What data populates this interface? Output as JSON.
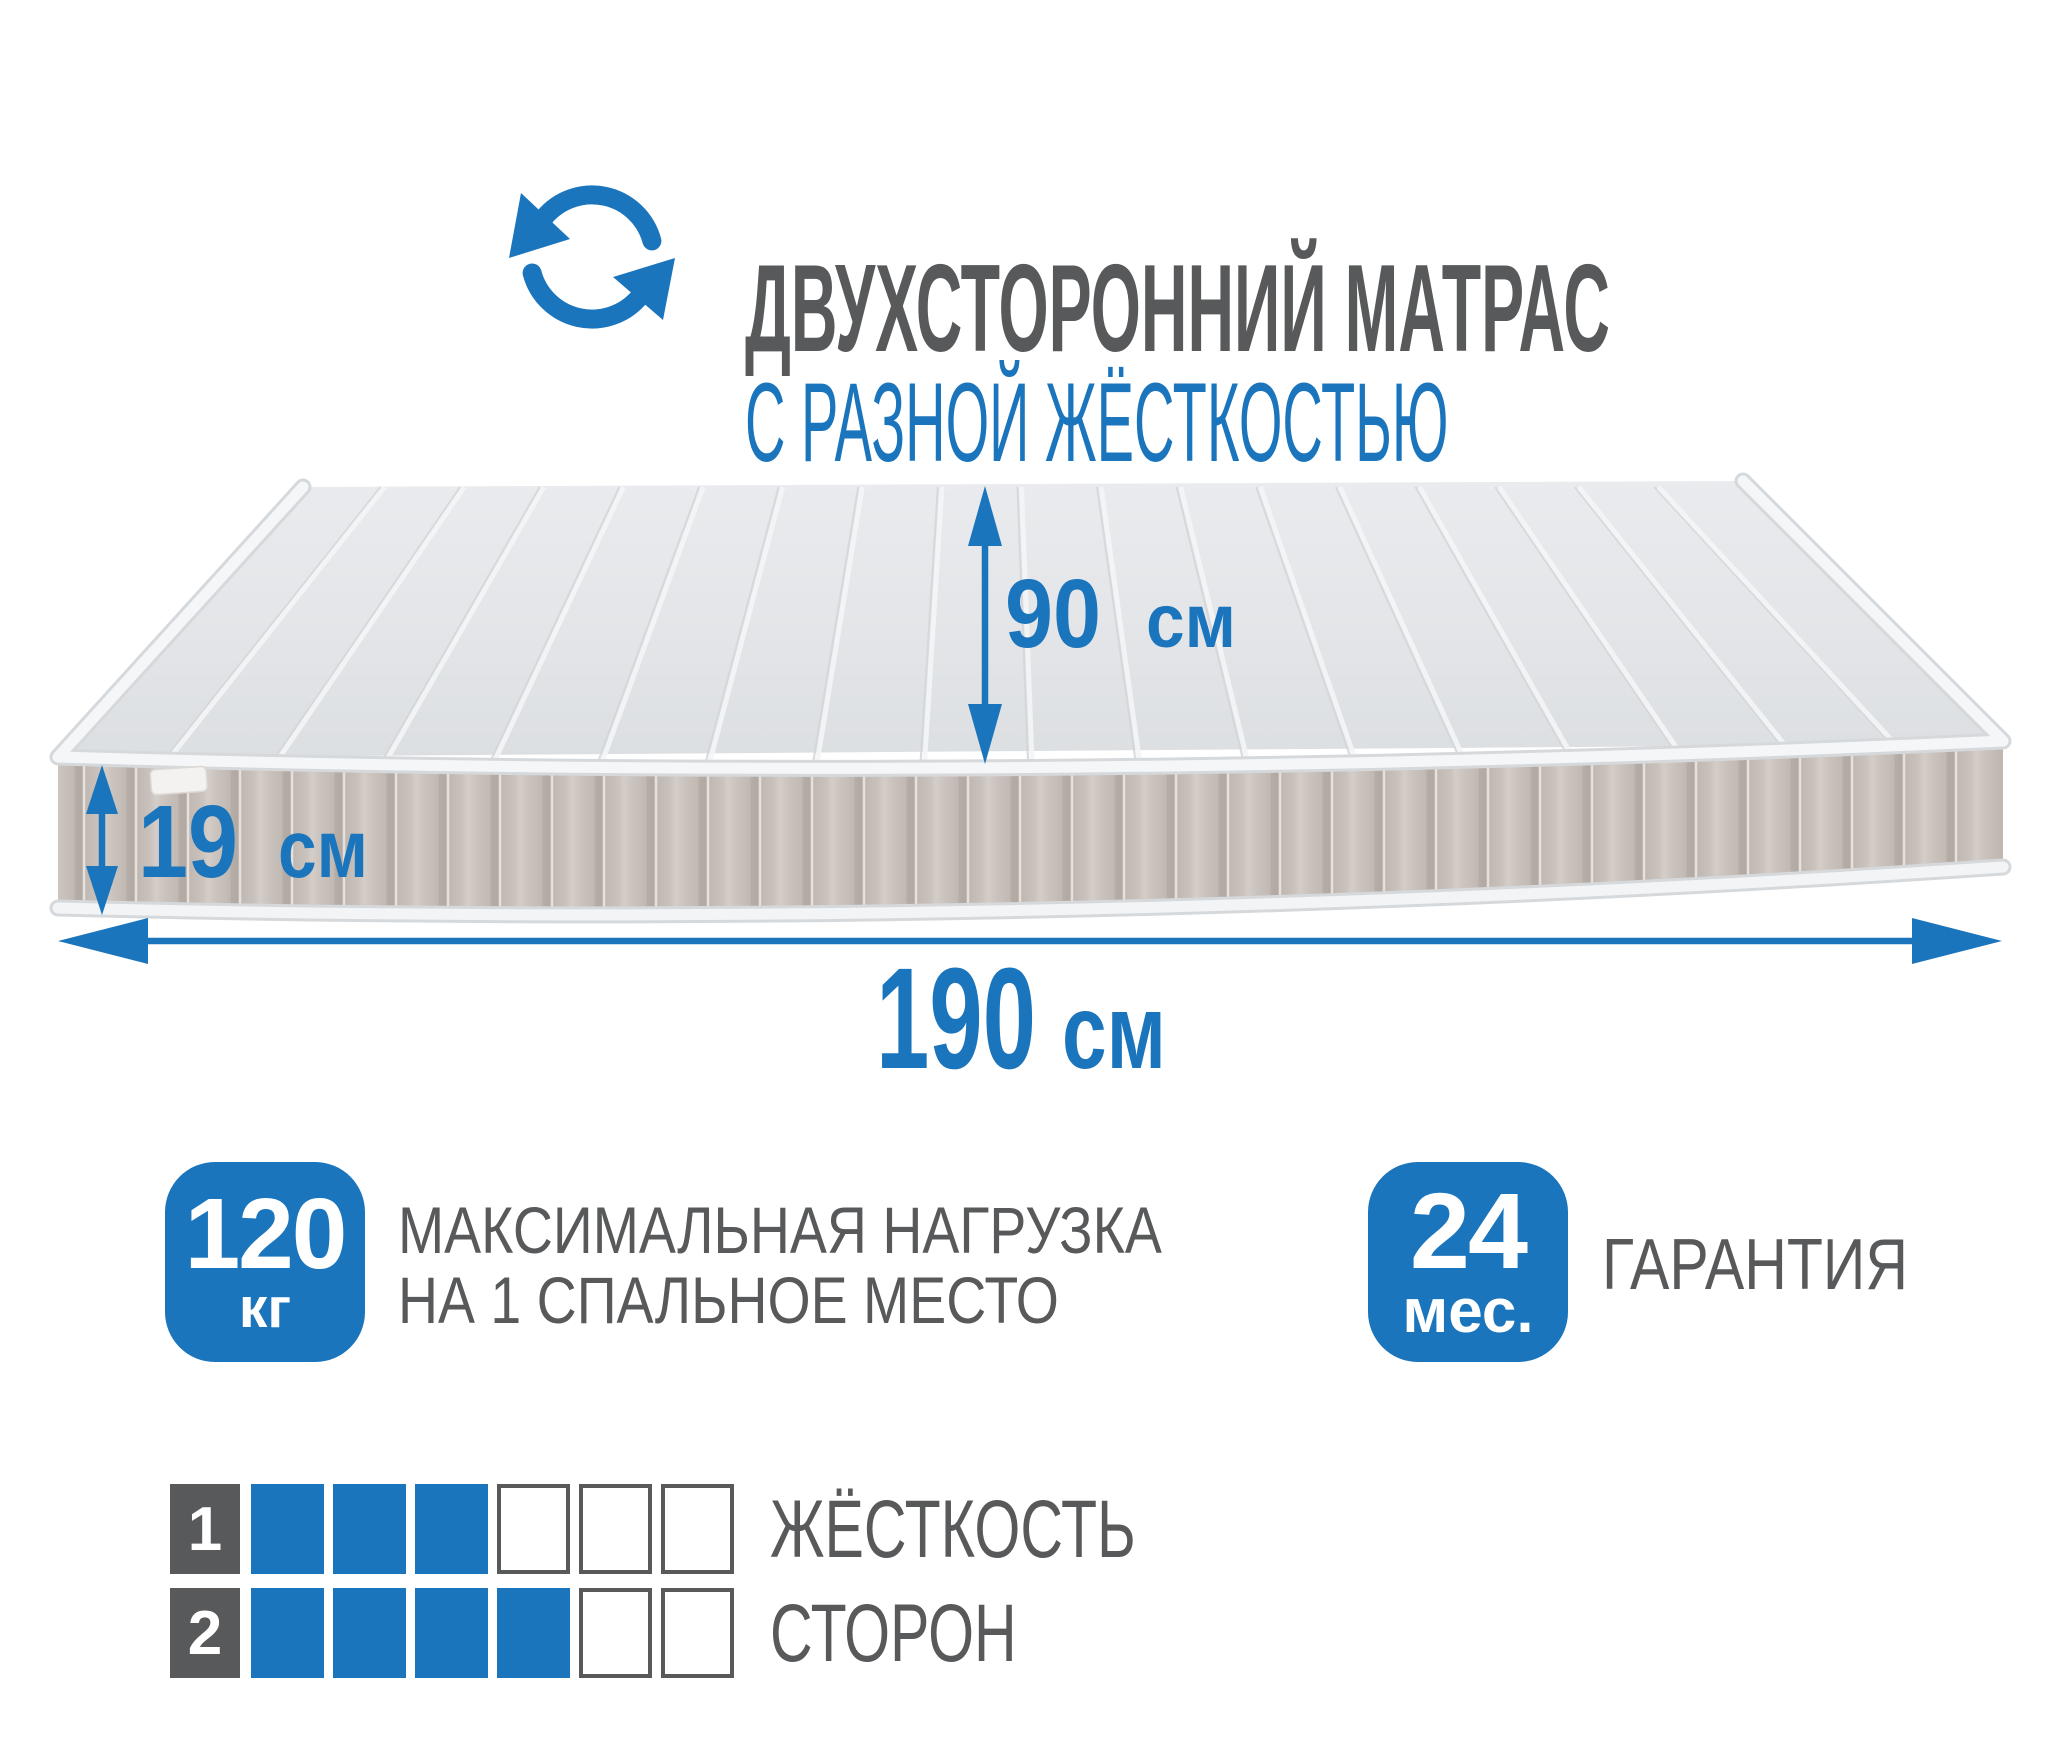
{
  "page": {
    "width": 2048,
    "height": 1757,
    "background": "#ffffff"
  },
  "colors": {
    "accent_blue": "#1b75bc",
    "text_gray": "#58595b",
    "mattress_top": "#e4e6e9",
    "mattress_side": "#c6bdb7",
    "piping_white": "#f5f6f8",
    "empty_cell_border": "#58595b"
  },
  "header": {
    "icon": "rotate-arrows",
    "title": "ДВУХСТОРОННИЙ МАТРАС",
    "subtitle": "С РАЗНОЙ ЖЁСТКОСТЬЮ"
  },
  "dimensions": {
    "width": {
      "value": "90",
      "unit": "см"
    },
    "height": {
      "value": "19",
      "unit": "см"
    },
    "length": {
      "value": "190",
      "unit": "см"
    }
  },
  "max_load": {
    "value": "120",
    "unit": "кг",
    "label_line1": "МАКСИМАЛЬНАЯ НАГРУЗКА",
    "label_line2": "НА 1 СПАЛЬНОЕ МЕСТО"
  },
  "warranty": {
    "value": "24",
    "unit": "мес.",
    "label": "ГАРАНТИЯ"
  },
  "hardness": {
    "label_line1": "ЖЁСТКОСТЬ",
    "label_line2": "СТОРОН",
    "scale_max": 6,
    "rows": [
      {
        "label": "1",
        "value": 3
      },
      {
        "label": "2",
        "value": 4
      }
    ]
  }
}
